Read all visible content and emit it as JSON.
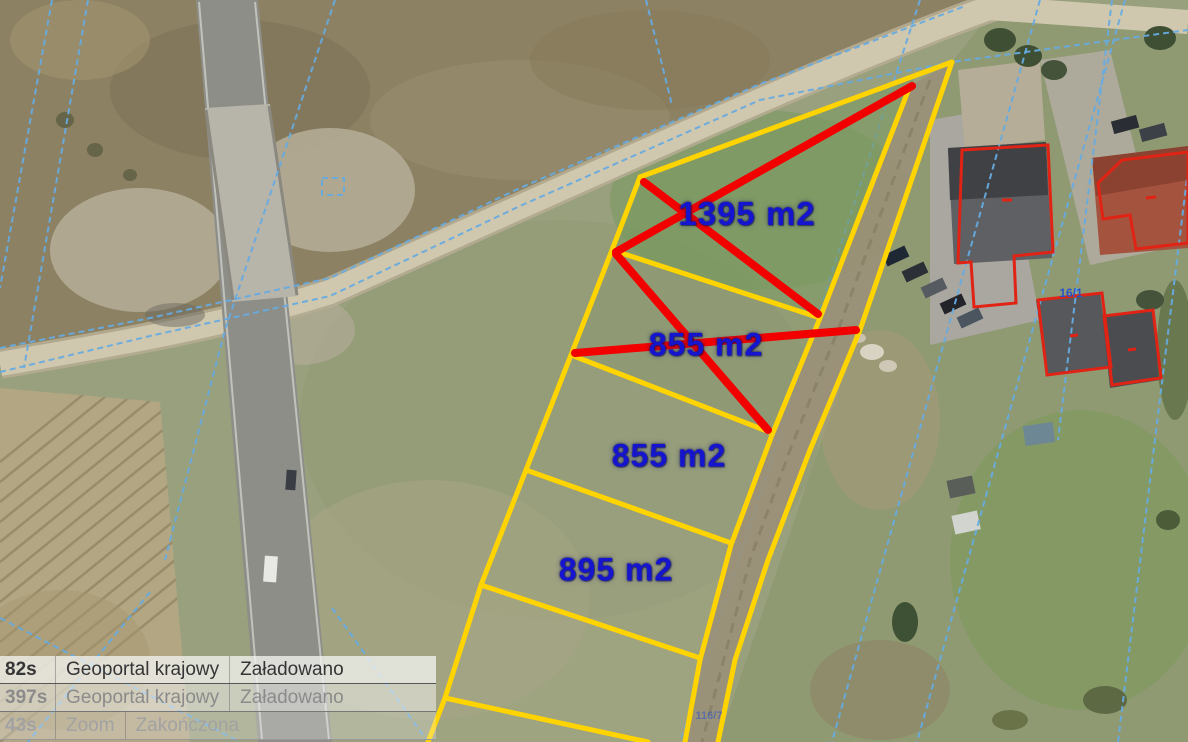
{
  "map": {
    "parcels": [
      {
        "area_label": "1395 m2",
        "crossed": true
      },
      {
        "area_label": "855 m2",
        "crossed": true
      },
      {
        "area_label": "855 m2",
        "crossed": false
      },
      {
        "area_label": "895 m2",
        "crossed": false
      }
    ],
    "parcel_numbers": [
      {
        "label": "16/1"
      },
      {
        "label": "116/7"
      }
    ],
    "colors": {
      "parcel_outline": "#ffd400",
      "sold_cross": "#f20000",
      "area_label_text": "#1515cf",
      "cadastral_line": "#66abe0",
      "building_outline": "#e02314"
    }
  },
  "status_log": {
    "rows": [
      {
        "time": "82s",
        "source": "Geoportal krajowy",
        "status": "Załadowano"
      },
      {
        "time": "397s",
        "source": "Geoportal krajowy",
        "status": "Załadowano"
      },
      {
        "time": "43s",
        "source": "Zoom",
        "status": "Zakończona"
      }
    ]
  }
}
